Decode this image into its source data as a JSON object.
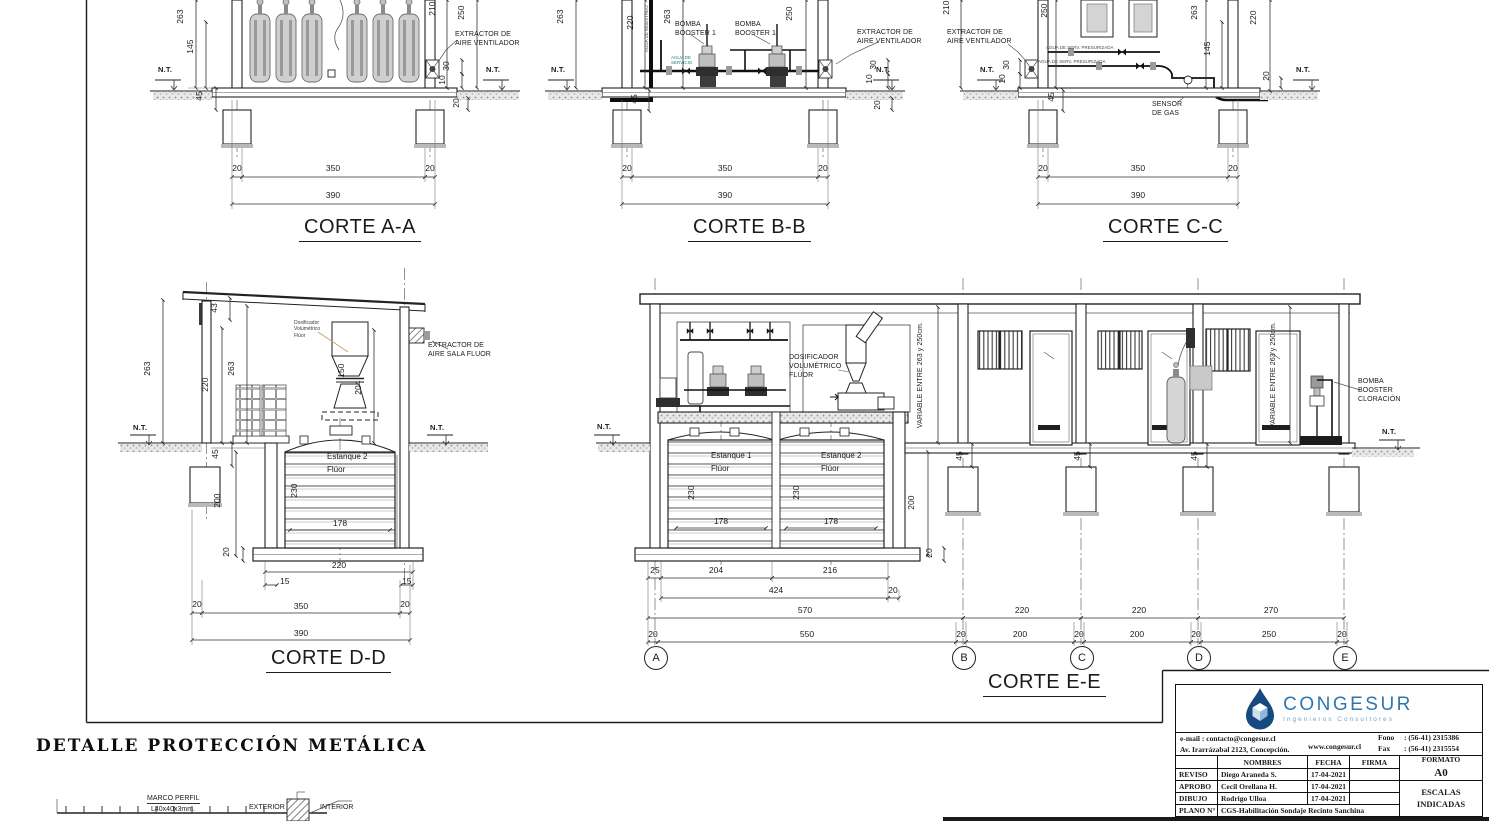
{
  "sheet": {
    "sections": {
      "aa_title": "CORTE A-A",
      "bb_title": "CORTE B-B",
      "cc_title": "CORTE C-C",
      "dd_title": "CORTE D-D",
      "ee_title": "CORTE E-E"
    },
    "common": {
      "grid": [
        "A",
        "B",
        "C",
        "D",
        "E"
      ]
    },
    "detalle": {
      "title": "DETALLE  PROTECCIÓN  METÁLICA",
      "marco_perfil": "MARCO PERFIL",
      "marco_spec": "L40x40x3mm.",
      "exterior": "EXTERIOR",
      "interior": "INTERIOR"
    }
  },
  "annotations": [
    {
      "t": "263",
      "x": 186,
      "y": 14,
      "cls": "v"
    },
    {
      "t": "145",
      "x": 196,
      "y": 44,
      "cls": "v"
    },
    {
      "t": "210",
      "x": 438,
      "y": 6,
      "cls": "v"
    },
    {
      "t": "250",
      "x": 467,
      "y": 10,
      "cls": "v"
    },
    {
      "t": "30",
      "x": 452,
      "y": 61,
      "cls": "v"
    },
    {
      "t": "10",
      "x": 448,
      "y": 75,
      "cls": "v"
    },
    {
      "t": "20",
      "x": 462,
      "y": 98,
      "cls": "v"
    },
    {
      "t": "45",
      "x": 205,
      "y": 91,
      "cls": "v"
    },
    {
      "t": "20",
      "x": 237,
      "y": 164,
      "cls": "c"
    },
    {
      "t": "350",
      "x": 333,
      "y": 164,
      "cls": "c"
    },
    {
      "t": "20",
      "x": 430,
      "y": 164,
      "cls": "c"
    },
    {
      "t": "390",
      "x": 333,
      "y": 191,
      "cls": "c"
    },
    {
      "t": "N.T.",
      "x": 158,
      "y": 66,
      "cls": "nt",
      "n": "nt-label"
    },
    {
      "t": "N.T.",
      "x": 486,
      "y": 66,
      "cls": "nt",
      "n": "nt-label"
    },
    {
      "t": "EXTRACTOR DE\nAIRE VENTILADOR",
      "x": 455,
      "y": 30,
      "cls": "co",
      "n": "extractor-aire-label"
    },
    {
      "t": "263",
      "x": 566,
      "y": 14,
      "cls": "v"
    },
    {
      "t": "220",
      "x": 636,
      "y": 20,
      "cls": "v"
    },
    {
      "t": "263",
      "x": 673,
      "y": 14,
      "cls": "v"
    },
    {
      "t": "250",
      "x": 795,
      "y": 11,
      "cls": "v"
    },
    {
      "t": "45",
      "x": 640,
      "y": 94,
      "cls": "v"
    },
    {
      "t": "30",
      "x": 879,
      "y": 60,
      "cls": "v"
    },
    {
      "t": "10",
      "x": 875,
      "y": 74,
      "cls": "v"
    },
    {
      "t": "20",
      "x": 883,
      "y": 100,
      "cls": "v"
    },
    {
      "t": "20",
      "x": 627,
      "y": 164,
      "cls": "c"
    },
    {
      "t": "350",
      "x": 725,
      "y": 164,
      "cls": "c"
    },
    {
      "t": "20",
      "x": 823,
      "y": 164,
      "cls": "c"
    },
    {
      "t": "390",
      "x": 725,
      "y": 191,
      "cls": "c"
    },
    {
      "t": "N.T.",
      "x": 551,
      "y": 66,
      "cls": "nt",
      "n": "nt-label"
    },
    {
      "t": "N.T.",
      "x": 876,
      "y": 66,
      "cls": "nt",
      "n": "nt-label"
    },
    {
      "t": "BOMBA\nBOOSTER 1",
      "x": 675,
      "y": 20,
      "cls": "co",
      "n": "bomba-booster-label"
    },
    {
      "t": "BOMBA\nBOOSTER 1",
      "x": 735,
      "y": 20,
      "cls": "co",
      "n": "bomba-booster-label"
    },
    {
      "t": "AGUA DE MUESTREO",
      "x": 649,
      "y": 47,
      "cls": "v ty",
      "n": "agua-muestreo-label"
    },
    {
      "t": "AGUA DE\nSERVICIO",
      "x": 671,
      "y": 55,
      "cls": "ty teal",
      "n": "agua-servicio-label"
    },
    {
      "t": "EXTRACTOR DE\nAIRE VENTILADOR",
      "x": 857,
      "y": 28,
      "cls": "co",
      "n": "extractor-aire-label"
    },
    {
      "t": "210",
      "x": 952,
      "y": 5,
      "cls": "v"
    },
    {
      "t": "250",
      "x": 1050,
      "y": 8,
      "cls": "v"
    },
    {
      "t": "30",
      "x": 1012,
      "y": 60,
      "cls": "v"
    },
    {
      "t": "10",
      "x": 1008,
      "y": 74,
      "cls": "v"
    },
    {
      "t": "45",
      "x": 1057,
      "y": 92,
      "cls": "v"
    },
    {
      "t": "263",
      "x": 1200,
      "y": 10,
      "cls": "v"
    },
    {
      "t": "145",
      "x": 1213,
      "y": 46,
      "cls": "v"
    },
    {
      "t": "220",
      "x": 1259,
      "y": 15,
      "cls": "v"
    },
    {
      "t": "20",
      "x": 1272,
      "y": 71,
      "cls": "v"
    },
    {
      "t": "20",
      "x": 1043,
      "y": 164,
      "cls": "c"
    },
    {
      "t": "350",
      "x": 1138,
      "y": 164,
      "cls": "c"
    },
    {
      "t": "20",
      "x": 1233,
      "y": 164,
      "cls": "c"
    },
    {
      "t": "390",
      "x": 1138,
      "y": 191,
      "cls": "c"
    },
    {
      "t": "N.T.",
      "x": 980,
      "y": 66,
      "cls": "nt",
      "n": "nt-label"
    },
    {
      "t": "N.T.",
      "x": 1296,
      "y": 66,
      "cls": "nt",
      "n": "nt-label"
    },
    {
      "t": "SENSOR\nDE GAS",
      "x": 1152,
      "y": 100,
      "cls": "co",
      "n": "sensor-gas-label"
    },
    {
      "t": "EXTRACTOR DE\nAIRE VENTILADOR",
      "x": 947,
      "y": 28,
      "cls": "co",
      "n": "extractor-aire-label"
    },
    {
      "t": "AGUA DE SERV. PRESURIZADA",
      "x": 1046,
      "y": 45,
      "cls": "ty",
      "n": "pipe-label"
    },
    {
      "t": "AGUA DE SERV. PRESURIZADA",
      "x": 1038,
      "y": 59,
      "cls": "ty",
      "n": "pipe-label"
    },
    {
      "t": "43",
      "x": 220,
      "y": 303,
      "cls": "v"
    },
    {
      "t": "263",
      "x": 153,
      "y": 366,
      "cls": "v"
    },
    {
      "t": "220",
      "x": 211,
      "y": 382,
      "cls": "v"
    },
    {
      "t": "263",
      "x": 237,
      "y": 366,
      "cls": "v"
    },
    {
      "t": "150",
      "x": 347,
      "y": 368,
      "cls": "v"
    },
    {
      "t": "204",
      "x": 364,
      "y": 385,
      "cls": "v"
    },
    {
      "t": "45",
      "x": 221,
      "y": 449,
      "cls": "v"
    },
    {
      "t": "200",
      "x": 223,
      "y": 498,
      "cls": "v"
    },
    {
      "t": "230",
      "x": 300,
      "y": 488,
      "cls": "v"
    },
    {
      "t": "20",
      "x": 232,
      "y": 547,
      "cls": "v"
    },
    {
      "t": "178",
      "x": 340,
      "y": 519,
      "cls": "c"
    },
    {
      "t": "220",
      "x": 339,
      "y": 561,
      "cls": "c"
    },
    {
      "t": "15",
      "x": 280,
      "y": 577
    },
    {
      "t": "15",
      "x": 402,
      "y": 577
    },
    {
      "t": "20",
      "x": 197,
      "y": 600,
      "cls": "c"
    },
    {
      "t": "350",
      "x": 301,
      "y": 602,
      "cls": "c"
    },
    {
      "t": "20",
      "x": 405,
      "y": 600,
      "cls": "c"
    },
    {
      "t": "390",
      "x": 301,
      "y": 629,
      "cls": "c"
    },
    {
      "t": "N.T.",
      "x": 133,
      "y": 424,
      "cls": "nt",
      "n": "nt-label"
    },
    {
      "t": "N.T.",
      "x": 430,
      "y": 424,
      "cls": "nt",
      "n": "nt-label"
    },
    {
      "t": "EXTRACTOR DE\nAIRE SALA FLUOR",
      "x": 428,
      "y": 341,
      "cls": "co",
      "n": "extractor-sala-fluor-label"
    },
    {
      "t": "Dosificador\nVolumétrico\nFlúor",
      "x": 294,
      "y": 320,
      "cls": "ty2",
      "n": "dosificador-label"
    },
    {
      "t": "Estanque 2",
      "x": 327,
      "y": 452,
      "cls": "es",
      "n": "estanque-label"
    },
    {
      "t": "Flúor",
      "x": 327,
      "y": 465,
      "cls": "es",
      "n": "estanque-label"
    },
    {
      "t": "DOSIFICADOR\nVOLUMÉTRICO\nFLÚOR",
      "x": 789,
      "y": 353,
      "cls": "co",
      "n": "dosificador-label"
    },
    {
      "t": "VARIABLE  ENTRE  263  y  250cm.",
      "x": 925,
      "y": 419,
      "cls": "v co",
      "n": "variable-dim-label"
    },
    {
      "t": "VARIABLE  ENTRE  263  y  250cm.",
      "x": 1278,
      "y": 419,
      "cls": "v co",
      "n": "variable-dim-label"
    },
    {
      "t": "Estanque 1",
      "x": 711,
      "y": 451,
      "cls": "es",
      "n": "estanque-label"
    },
    {
      "t": "Flúor",
      "x": 711,
      "y": 464,
      "cls": "es",
      "n": "estanque-label"
    },
    {
      "t": "Estanque 2",
      "x": 821,
      "y": 451,
      "cls": "es",
      "n": "estanque-label"
    },
    {
      "t": "Flúor",
      "x": 821,
      "y": 464,
      "cls": "es",
      "n": "estanque-label"
    },
    {
      "t": "230",
      "x": 697,
      "y": 490,
      "cls": "v"
    },
    {
      "t": "230",
      "x": 802,
      "y": 490,
      "cls": "v"
    },
    {
      "t": "178",
      "x": 721,
      "y": 517,
      "cls": "c"
    },
    {
      "t": "178",
      "x": 831,
      "y": 517,
      "cls": "c"
    },
    {
      "t": "200",
      "x": 917,
      "y": 500,
      "cls": "v"
    },
    {
      "t": "20",
      "x": 935,
      "y": 548,
      "cls": "v"
    },
    {
      "t": "45",
      "x": 965,
      "y": 451,
      "cls": "v"
    },
    {
      "t": "45",
      "x": 1083,
      "y": 451,
      "cls": "v"
    },
    {
      "t": "45",
      "x": 1200,
      "y": 451,
      "cls": "v"
    },
    {
      "t": "N.T.",
      "x": 597,
      "y": 423,
      "cls": "nt",
      "n": "nt-label"
    },
    {
      "t": "N.T.",
      "x": 1382,
      "y": 428,
      "cls": "nt",
      "n": "nt-label"
    },
    {
      "t": "BOMBA\nBOOSTER\nCLORACIÓN",
      "x": 1358,
      "y": 377,
      "cls": "co",
      "n": "bomba-cloracion-label"
    },
    {
      "t": "25",
      "x": 655,
      "y": 566,
      "cls": "c"
    },
    {
      "t": "204",
      "x": 716,
      "y": 566,
      "cls": "c"
    },
    {
      "t": "216",
      "x": 830,
      "y": 566,
      "cls": "c"
    },
    {
      "t": "424",
      "x": 776,
      "y": 586,
      "cls": "c"
    },
    {
      "t": "20",
      "x": 893,
      "y": 586,
      "cls": "c"
    },
    {
      "t": "570",
      "x": 805,
      "y": 606,
      "cls": "c"
    },
    {
      "t": "220",
      "x": 1022,
      "y": 606,
      "cls": "c"
    },
    {
      "t": "220",
      "x": 1139,
      "y": 606,
      "cls": "c"
    },
    {
      "t": "270",
      "x": 1271,
      "y": 606,
      "cls": "c"
    },
    {
      "t": "20",
      "x": 653,
      "y": 630,
      "cls": "c"
    },
    {
      "t": "550",
      "x": 807,
      "y": 630,
      "cls": "c"
    },
    {
      "t": "20",
      "x": 961,
      "y": 630,
      "cls": "c"
    },
    {
      "t": "200",
      "x": 1020,
      "y": 630,
      "cls": "c"
    },
    {
      "t": "20",
      "x": 1079,
      "y": 630,
      "cls": "c"
    },
    {
      "t": "200",
      "x": 1137,
      "y": 630,
      "cls": "c"
    },
    {
      "t": "20",
      "x": 1196,
      "y": 630,
      "cls": "c"
    },
    {
      "t": "250",
      "x": 1269,
      "y": 630,
      "cls": "c"
    },
    {
      "t": "20",
      "x": 1342,
      "y": 630,
      "cls": "c"
    }
  ],
  "title_block": {
    "company": "CONGESUR",
    "company_sub": "Ingenieros Consultores",
    "email": "e-mail : contacto@congesur.cl",
    "address": "Av. Irarrázabal 2123, Concepción.",
    "web": "www.congesur.cl",
    "fono_label": "Fono",
    "fono_value": ": (56-41) 2315386",
    "fax_label": "Fax",
    "fax_value": ": (56-41) 2315554",
    "col_nombres": "NOMBRES",
    "col_fecha": "FECHA",
    "col_firma": "FIRMA",
    "rows": [
      {
        "label": "REVISO",
        "name": "Diego Araneda S.",
        "date": "17-04-2021"
      },
      {
        "label": "APROBO",
        "name": "Cecil Orellana H.",
        "date": "17-04-2021"
      },
      {
        "label": "DIBUJO",
        "name": "Rodrigo Ulloa",
        "date": "17-04-2021"
      }
    ],
    "plano_label": "PLANO N°",
    "plano_value": "CGS-Habilitación Sondaje Recinto Sanchina",
    "formato_label": "FORMATO",
    "formato_value": "A0",
    "escalas": "ESCALAS\nINDICADAS"
  }
}
